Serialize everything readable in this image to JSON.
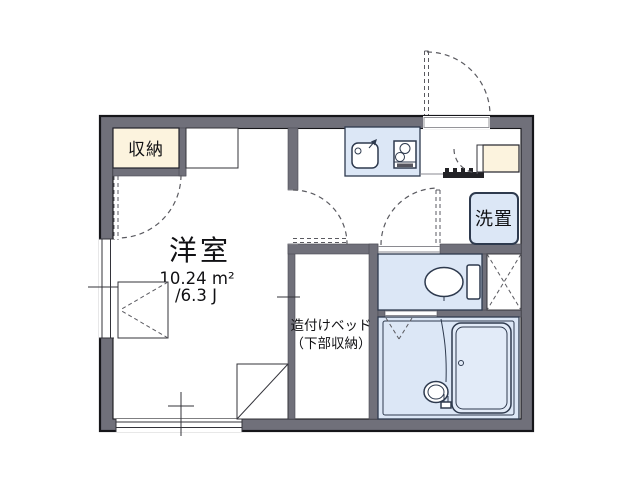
{
  "floor_plan": {
    "labels": {
      "closet": "収納",
      "room": "洋室",
      "area_sqm": "10.24 m²",
      "area_tatami": "/6.3 J",
      "built_in_bed_line1": "造付けベッド",
      "built_in_bed_line2": "（下部収納）",
      "laundry": "洗置"
    },
    "colors": {
      "wall": "#70707a",
      "closet_fill": "#fcf3de",
      "water_fill": "#dce7f6",
      "fixture_stroke": "#2e3a4e"
    },
    "icons": [
      "sink-icon",
      "stove-icon",
      "toilet-icon",
      "bathtub-icon",
      "washbasin-icon",
      "door-swing-arc",
      "window-symbol",
      "pipe-shaft-cross",
      "entrance-step"
    ]
  }
}
